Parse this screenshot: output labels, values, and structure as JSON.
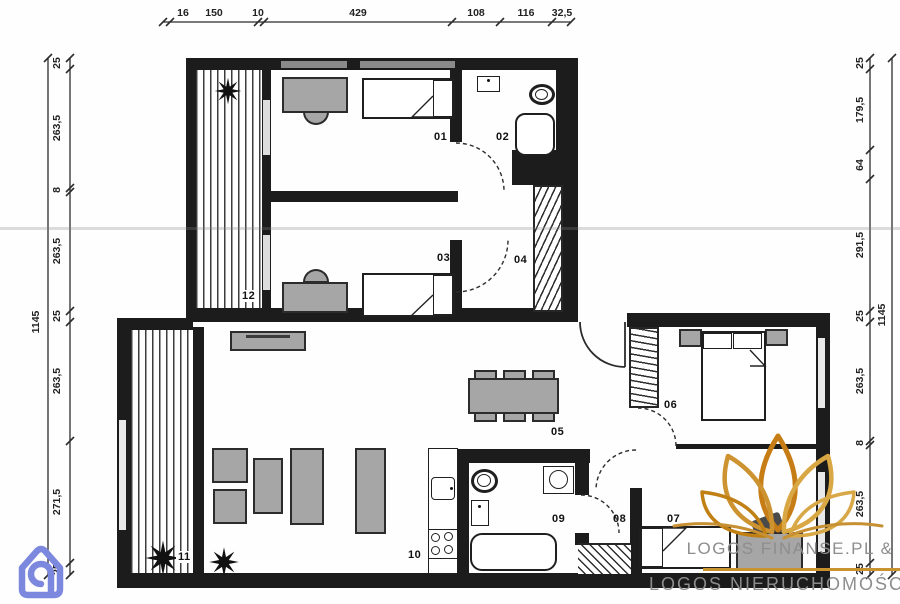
{
  "plan": {
    "rooms": {
      "r01": "01",
      "r02": "02",
      "r03": "03",
      "r04": "04",
      "r05": "05",
      "r06": "06",
      "r07": "07",
      "r08": "08",
      "r09": "09",
      "r10": "10",
      "r11": "11",
      "r12": "12"
    }
  },
  "dimensions": {
    "top": {
      "segments": [
        "16",
        "150",
        "10",
        "429",
        "108",
        "116",
        "32,5"
      ]
    },
    "left": {
      "total": "1145",
      "segments": [
        "25",
        "263,5",
        "8",
        "263,5",
        "25",
        "263,5",
        "271,5",
        "25"
      ]
    },
    "right": {
      "total": "1145",
      "segments": [
        "25",
        "179,5",
        "64",
        "291,5",
        "25",
        "263,5",
        "8",
        "263,5",
        "25"
      ]
    }
  },
  "branding": {
    "line1": "LOGOS FINANSE.PL &",
    "line2": "LOGOS NIERUCHOMOŚCI"
  },
  "colors": {
    "wall": "#1c1c1c",
    "furniture": "#a6a6a6",
    "gold": "#c8932f",
    "logo_text": "#8d8d8d",
    "icon_blue": "#7c87de"
  }
}
